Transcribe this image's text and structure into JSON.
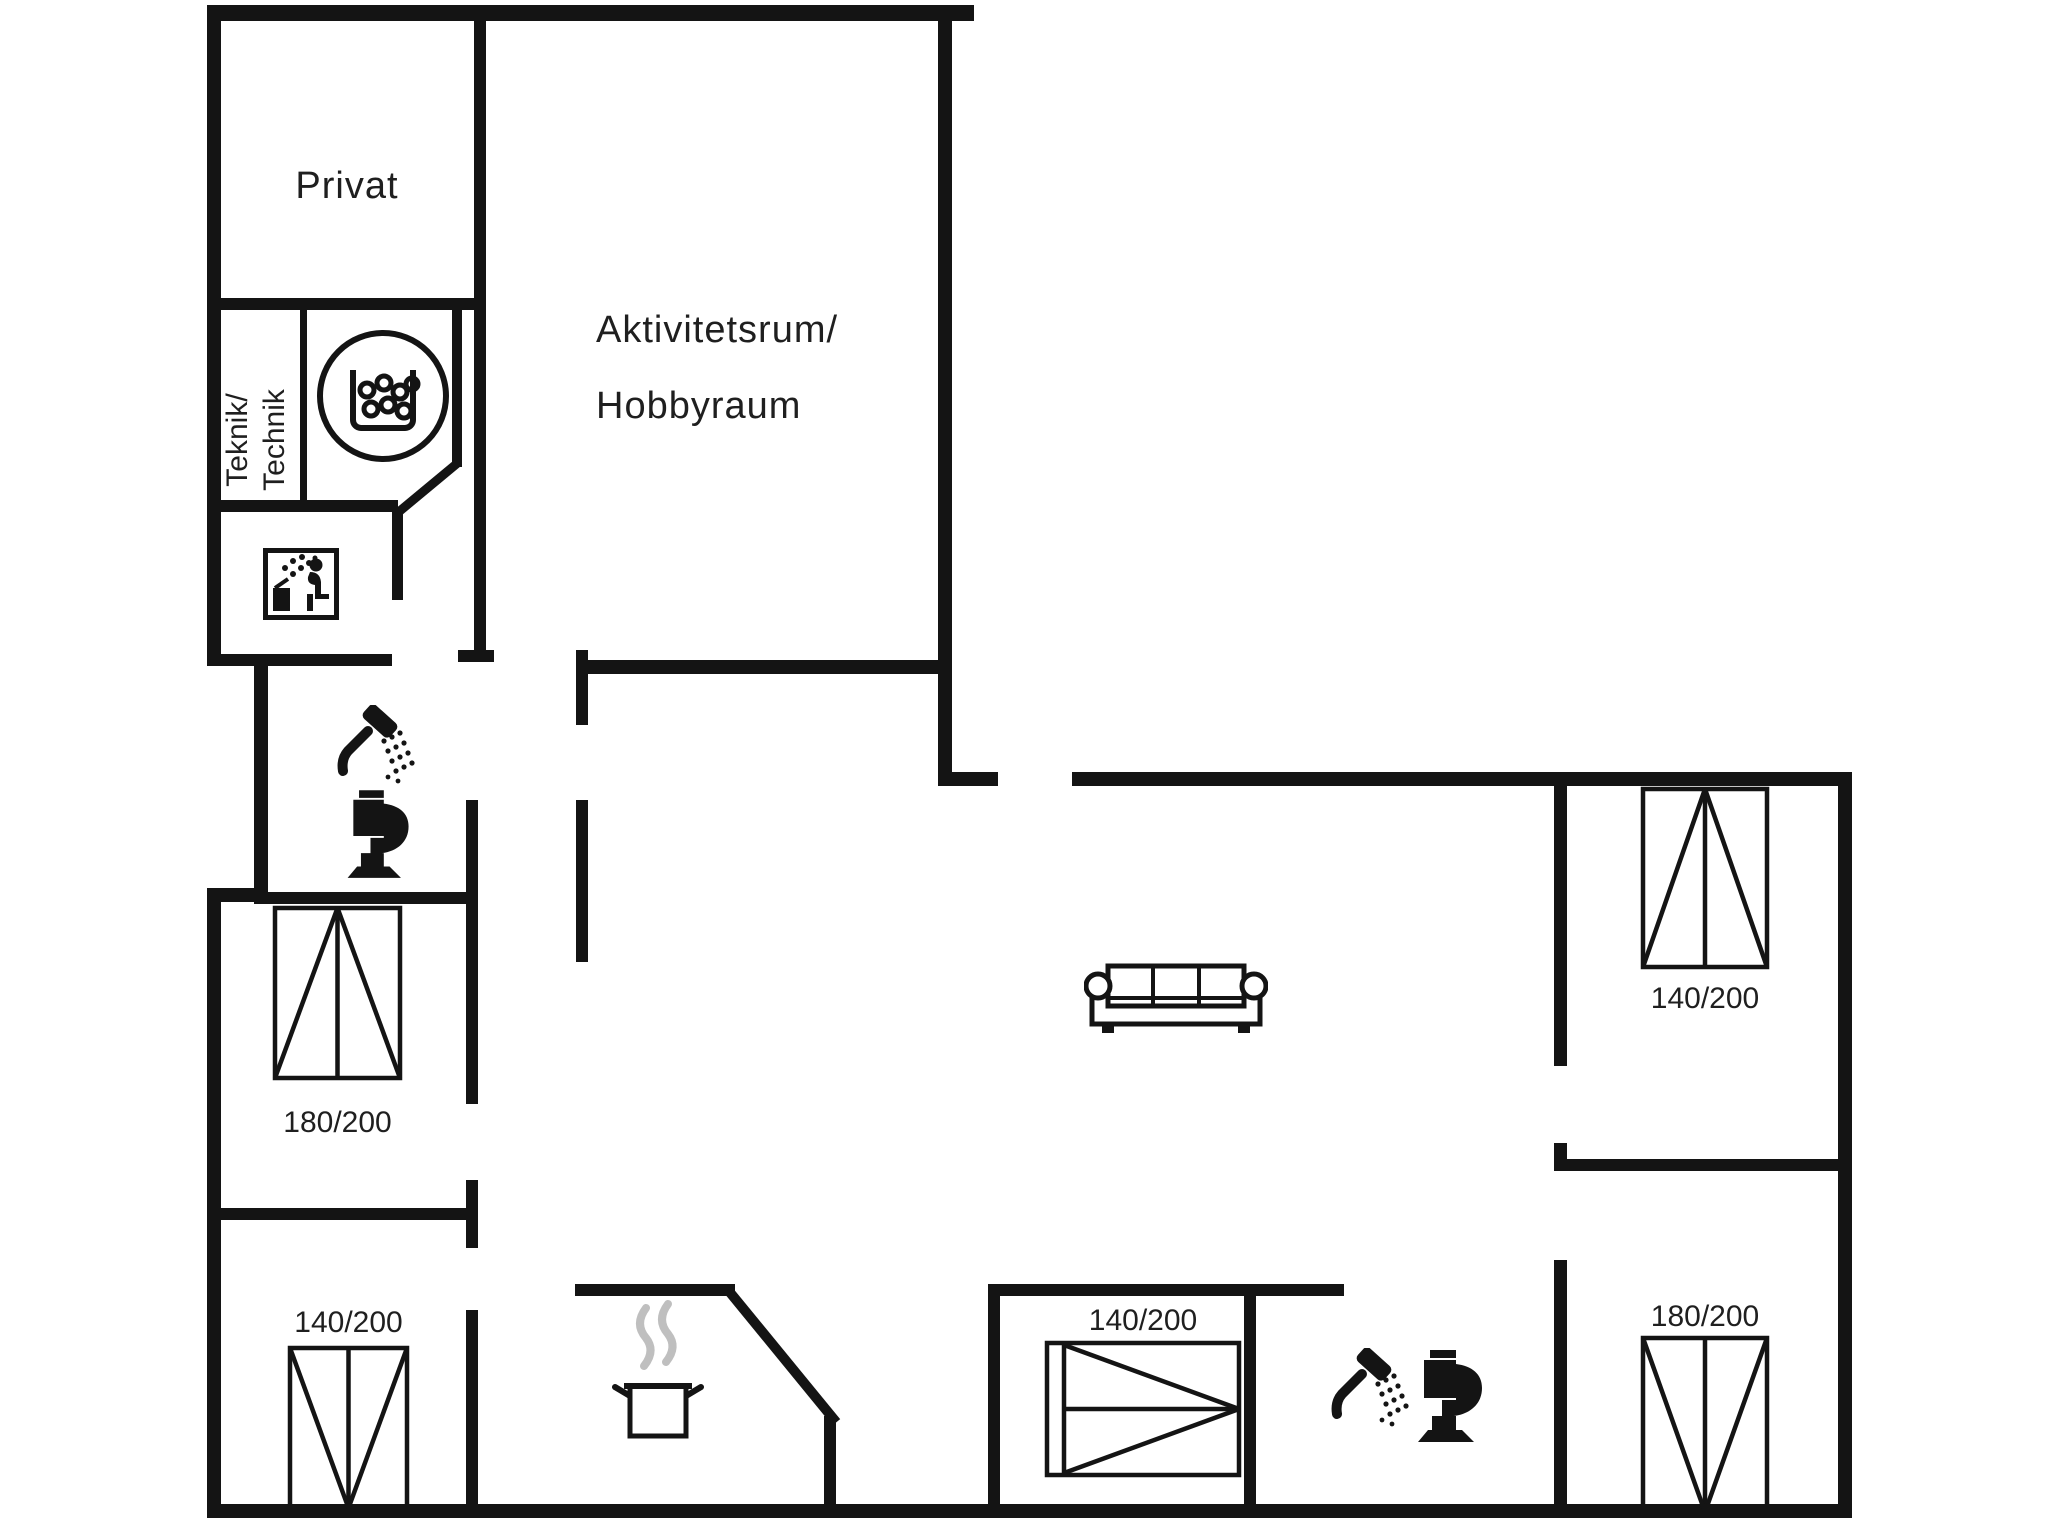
{
  "meta": {
    "background_color": "#ffffff",
    "wall_color": "#141414",
    "steam_color": "#bfbfbf",
    "drawing_type": "floor-plan"
  },
  "rooms": {
    "privat": {
      "label": "Privat"
    },
    "activity": {
      "line1": "Aktivitetsrum/",
      "line2": "Hobbyraum"
    },
    "technik": {
      "line1": "Teknik/",
      "line2": "Technik"
    }
  },
  "beds": [
    {
      "location": "left-bedroom",
      "size": "180/200"
    },
    {
      "location": "bottom-left-bedroom",
      "size": "140/200"
    },
    {
      "location": "bottom-middle-bedroom",
      "size": "140/200"
    },
    {
      "location": "top-right-bedroom",
      "size": "140/200"
    },
    {
      "location": "bottom-right-bedroom",
      "size": "180/200"
    }
  ],
  "icons": {
    "washing_machine": "washing-machine-icon",
    "sauna": "sauna-icon",
    "shower": "shower-icon",
    "toilet": "toilet-icon",
    "sofa": "sofa-icon",
    "cooking_pot": "cooking-pot-icon"
  }
}
